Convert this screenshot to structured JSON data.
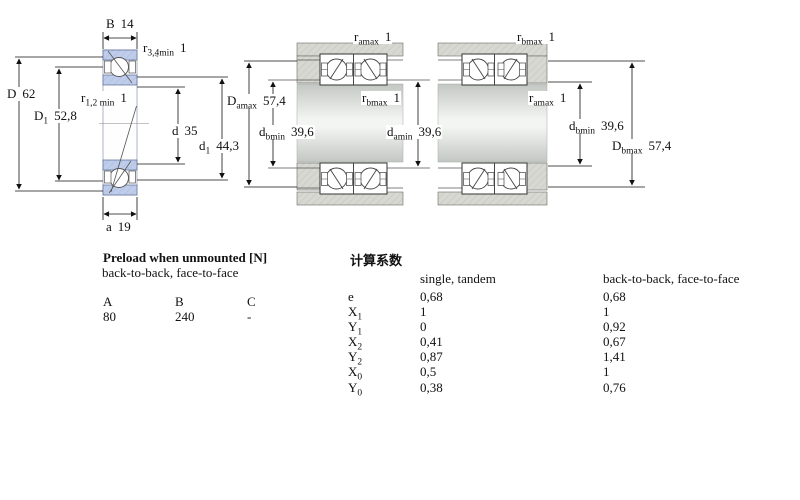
{
  "left_diagram": {
    "dims": {
      "B": {
        "base": "B",
        "sub": "",
        "value": "14"
      },
      "r34": {
        "base": "r",
        "sub": "3,4min",
        "value": "1"
      },
      "D": {
        "base": "D",
        "sub": "",
        "value": "62"
      },
      "r12": {
        "base": "r",
        "sub": "1,2 min",
        "value": "1"
      },
      "D1": {
        "base": "D",
        "sub": "1",
        "value": "52,8"
      },
      "d": {
        "base": "d",
        "sub": "",
        "value": "35"
      },
      "d1": {
        "base": "d",
        "sub": "1",
        "value": "44,3"
      },
      "a": {
        "base": "a",
        "sub": "",
        "value": "19"
      }
    }
  },
  "middle_diagram": {
    "dims": {
      "r_amax": {
        "base": "r",
        "sub": "amax",
        "value": "1"
      },
      "D_amax": {
        "base": "D",
        "sub": "amax",
        "value": "57,4"
      },
      "r_bmax": {
        "base": "r",
        "sub": "bmax",
        "value": "1"
      },
      "d_bmin": {
        "base": "d",
        "sub": "bmin",
        "value": "39,6"
      },
      "d_amin": {
        "base": "d",
        "sub": "amin",
        "value": "39,6"
      }
    }
  },
  "right_diagram": {
    "dims": {
      "r_bmax": {
        "base": "r",
        "sub": "bmax",
        "value": "1"
      },
      "r_amax": {
        "base": "r",
        "sub": "amax",
        "value": "1"
      },
      "d_bmin": {
        "base": "d",
        "sub": "bmin",
        "value": "39,6"
      },
      "D_bmax": {
        "base": "D",
        "sub": "bmax",
        "value": "57,4"
      }
    }
  },
  "preload_table": {
    "title": "Preload when unmounted [N]",
    "subtitle": "back-to-back, face-to-face",
    "headers": [
      "A",
      "B",
      "C"
    ],
    "values": [
      "80",
      "240",
      "-"
    ]
  },
  "factors_table": {
    "title": "计算系数",
    "col1_header": "single, tandem",
    "col2_header": "back-to-back, face-to-face",
    "rows": [
      {
        "base": "e",
        "sub": "",
        "v1": "0,68",
        "v2": "0,68"
      },
      {
        "base": "X",
        "sub": "1",
        "v1": "1",
        "v2": "1"
      },
      {
        "base": "Y",
        "sub": "1",
        "v1": "0",
        "v2": "0,92"
      },
      {
        "base": "X",
        "sub": "2",
        "v1": "0,41",
        "v2": "0,67"
      },
      {
        "base": "Y",
        "sub": "2",
        "v1": "0,87",
        "v2": "1,41"
      },
      {
        "base": "X",
        "sub": "0",
        "v1": "0,5",
        "v2": "1"
      },
      {
        "base": "Y",
        "sub": "0",
        "v1": "0,38",
        "v2": "0,76"
      }
    ]
  },
  "colors": {
    "ring_blue": "#bfcdea",
    "housing_grey": "#d8d8d2",
    "line": "#1a1a1a"
  }
}
